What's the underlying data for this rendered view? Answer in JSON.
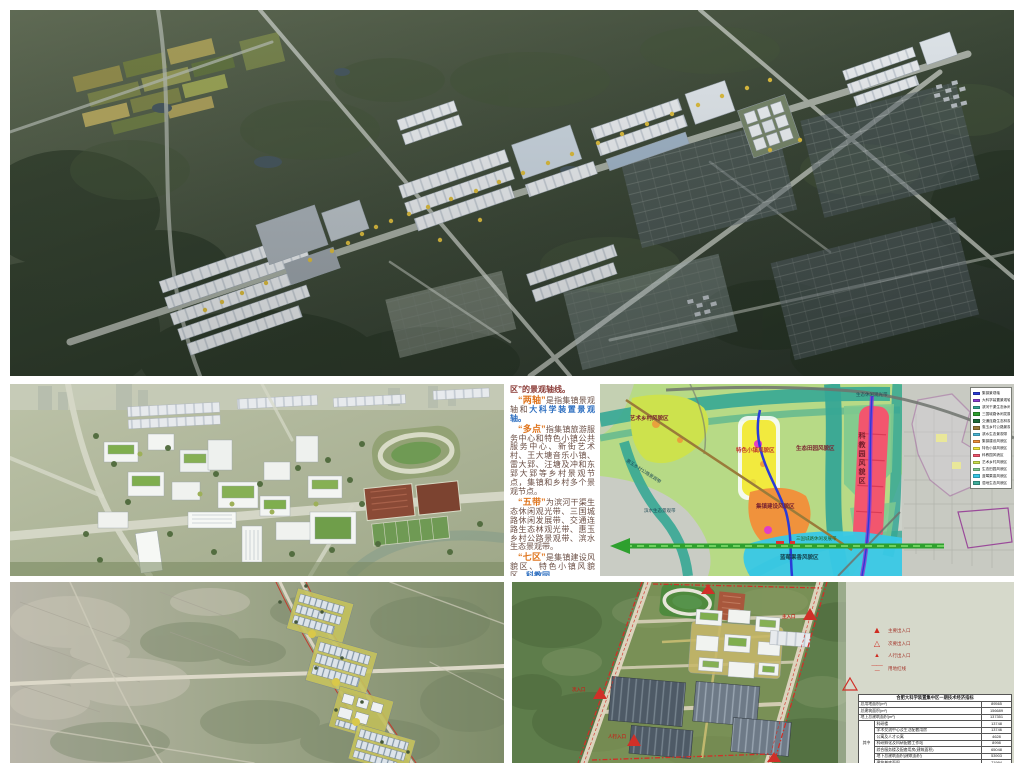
{
  "colors": {
    "page_bg": "#ffffff",
    "accent_orange": "#e0761f",
    "accent_blue": "#2e6fc0",
    "map_green": "#b7da86",
    "map_teal": "#36a795",
    "map_yellow": "#f2ea3e",
    "map_orange": "#f0923c",
    "map_red": "#f2566e",
    "map_cyan": "#38c8e6",
    "boundary_red": "#d03028"
  },
  "text_panel": {
    "intro": "区”的景观轴线。",
    "p_axes": {
      "quote": "“两轴”",
      "body1": "是指集镇景观轴和",
      "highlight": "大科学装置景观轴。"
    },
    "p_points": {
      "quote": "“多点”",
      "body": "指集镇旅游服务中心和特色小镇公共服务中心、新街艺术村、王大塘音乐小镇、雷大郢、汪塘及冲和东郢大郢等乡村景观节点，集镇和乡村多个景观节点。"
    },
    "p_belts": {
      "quote": "“五带”",
      "body": "为滨河干渠生态休闲观光带、三国城路休闲发展带、交通连路生态林观光带、惠玉乡村公路景观带、滨水生态景观带。"
    },
    "p_zones": {
      "quote": "“七区”",
      "body": "是集镇建设风貌区、特色小镇风貌区、",
      "highlight": "科教园"
    }
  },
  "map_panel": {
    "labels": {
      "art_village": "艺术乡村风貌区",
      "featured_town": "特色小镇风貌区",
      "eco_fields": "生态田园风貌区",
      "town_construction": "集镇建设风貌区",
      "science_park": "科教园风貌区",
      "blueberry": "蓝莓果香风貌区",
      "waterfront": "滨水生态景观带",
      "country_road": "惠玉乡村公路景观带",
      "leisure_belt": "生态休闲观光带",
      "sanguo_belt": "三国城路休闲发展带"
    },
    "legend": {
      "items": [
        {
          "label": "集镇景观轴",
          "color": "#2a3bd8"
        },
        {
          "label": "大科学装置景观轴",
          "color": "#8a3fd0"
        },
        {
          "label": "滨河干渠生态休闲观光带",
          "color": "#36a795"
        },
        {
          "label": "三国城路休闲发展带",
          "color": "#2ea02e"
        },
        {
          "label": "交通连路生态林观光带",
          "color": "#1f6b3a"
        },
        {
          "label": "惠玉乡村公路景观带",
          "color": "#9a7b3a"
        },
        {
          "label": "滨水生态景观带",
          "color": "#4ab8d8"
        },
        {
          "label": "集镇建设风貌区",
          "color": "#f0923c"
        },
        {
          "label": "特色小镇风貌区",
          "color": "#f2ea3e"
        },
        {
          "label": "科教园风貌区",
          "color": "#f2566e"
        },
        {
          "label": "艺术乡村风貌区",
          "color": "#cde24d"
        },
        {
          "label": "生态田园风貌区",
          "color": "#7ec98f"
        },
        {
          "label": "蓝莓果香风貌区",
          "color": "#38c8e6"
        },
        {
          "label": "湿地生态风貌区",
          "color": "#3fae9b"
        }
      ]
    }
  },
  "bottom_right_panel": {
    "entrances": {
      "main": "主入口",
      "secondary": "次入口",
      "pedestrian": "人行入口"
    },
    "legend": {
      "items": [
        {
          "symbol": "▲",
          "label": "主要出入口"
        },
        {
          "symbol": "△",
          "label": "次要出入口"
        },
        {
          "symbol": "▲",
          "label": "人行出入口"
        },
        {
          "symbol": "—·—·—",
          "label": "用地红线"
        }
      ]
    },
    "table": {
      "title": "合肥大科学装置集中区一期技术经济指标",
      "group_label": "其中",
      "rows": [
        {
          "label": "总用地面积(m²)",
          "value": "89565"
        },
        {
          "label": "总建筑面积(m²)",
          "value": "156689"
        },
        {
          "label": "地上总建筑面积(m²)",
          "value": "137351"
        },
        {
          "label": "科研楼",
          "value": "13748"
        },
        {
          "label": "学术交流中心及生活配套用房",
          "value": "13746"
        },
        {
          "label": "公寓及人才公寓",
          "value": "4628"
        },
        {
          "label": "科研孵化及科研配套工作站",
          "value": "8998"
        },
        {
          "label": "综合服务楼及配套用房(建筑面积)",
          "value": "65048"
        },
        {
          "label": "地下总建筑面积(建筑面积)",
          "value": "53903"
        },
        {
          "label": "建筑基底面积",
          "value": "71994"
        }
      ]
    }
  }
}
